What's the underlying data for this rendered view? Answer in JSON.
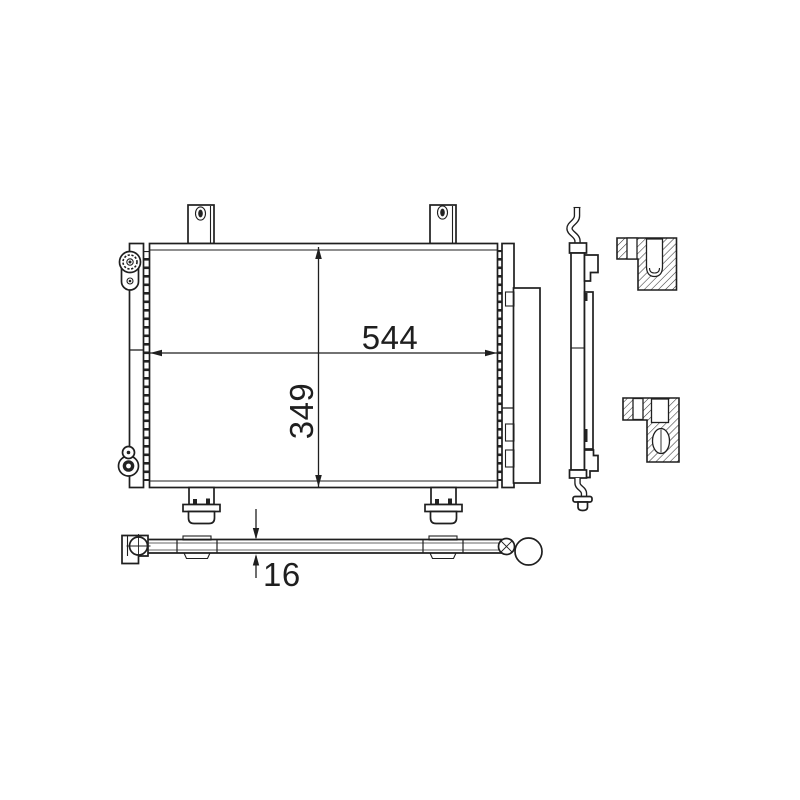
{
  "canvas": {
    "background": "#ffffff",
    "line_color": "#1f1f1f",
    "hatch_color": "#333333"
  },
  "dimension_labels": {
    "width": "544",
    "height": "349",
    "thickness": "16"
  }
}
